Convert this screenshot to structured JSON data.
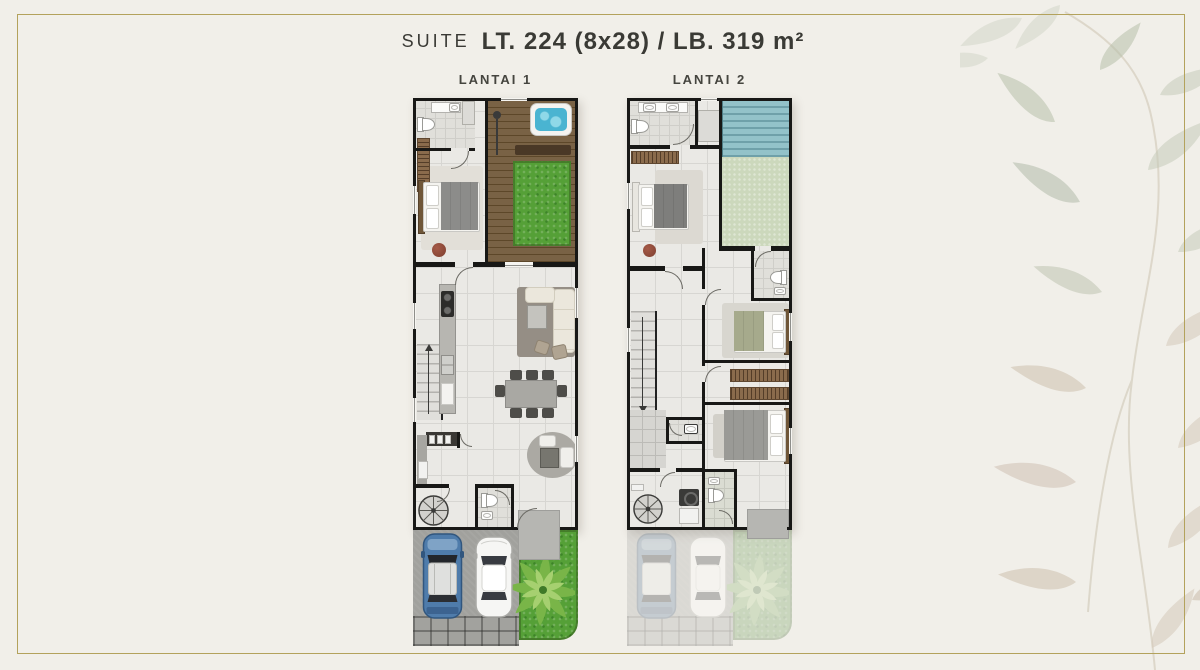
{
  "header": {
    "series": "SUITE",
    "spec": "LT. 224 (8x28) / LB. 319 m²"
  },
  "plans": {
    "floor1_label": "LANTAI 1",
    "floor2_label": "LANTAI 2"
  },
  "palette": {
    "bg": "#f1efe9",
    "frame": "#b3a25c",
    "ink": "#3a3a35",
    "wall": "#181816",
    "tile": "#eae9e5",
    "tile_line": "#d7d6d2",
    "bath_tile": "#e0dfda",
    "wood": "#6f5637",
    "wood_dark": "#5d4729",
    "grass": "#55a037",
    "pale_grass": "#ccd8bc",
    "water": "#4ab4d1",
    "roof_a": "#93c2c9",
    "roof_b": "#6fa0a9",
    "closet": "#8a6b4c",
    "pave": "#a1a19d",
    "pad": "#b6b6b2",
    "car_blue": "#4f7cab",
    "sofa": "#ebe7dc",
    "leaf_sage": "#bcc4b0",
    "leaf_beige": "#d5c9ba"
  }
}
